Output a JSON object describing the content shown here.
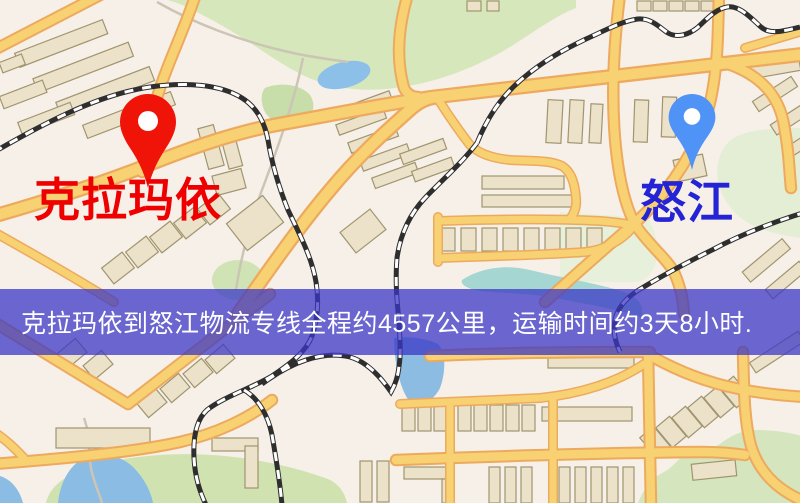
{
  "banner": {
    "text": "克拉玛依到怒江物流专线全程约4557公里，运输时间约3天8小时.",
    "bg_color": "rgba(58,54,199,0.74)",
    "text_color": "#ffffff",
    "distance_km": "4557",
    "duration_text": "3天8小时"
  },
  "origin": {
    "label": "克拉玛依",
    "label_color": "#ee0000",
    "pin_color": "#f01408"
  },
  "destination": {
    "label": "怒江",
    "label_color": "#2424d6",
    "pin_color": "#4f93f7"
  },
  "map": {
    "theme_colors": {
      "background": "#f7f0e9",
      "road_fill": "#f8d173",
      "road_casing": "#edaa5e",
      "park_green": "#d6e7bc",
      "water_blue": "#8cbce2",
      "river_teal": "#a5d6d1",
      "building": "#ebe2c9",
      "railway": "#2e2e2e"
    }
  }
}
